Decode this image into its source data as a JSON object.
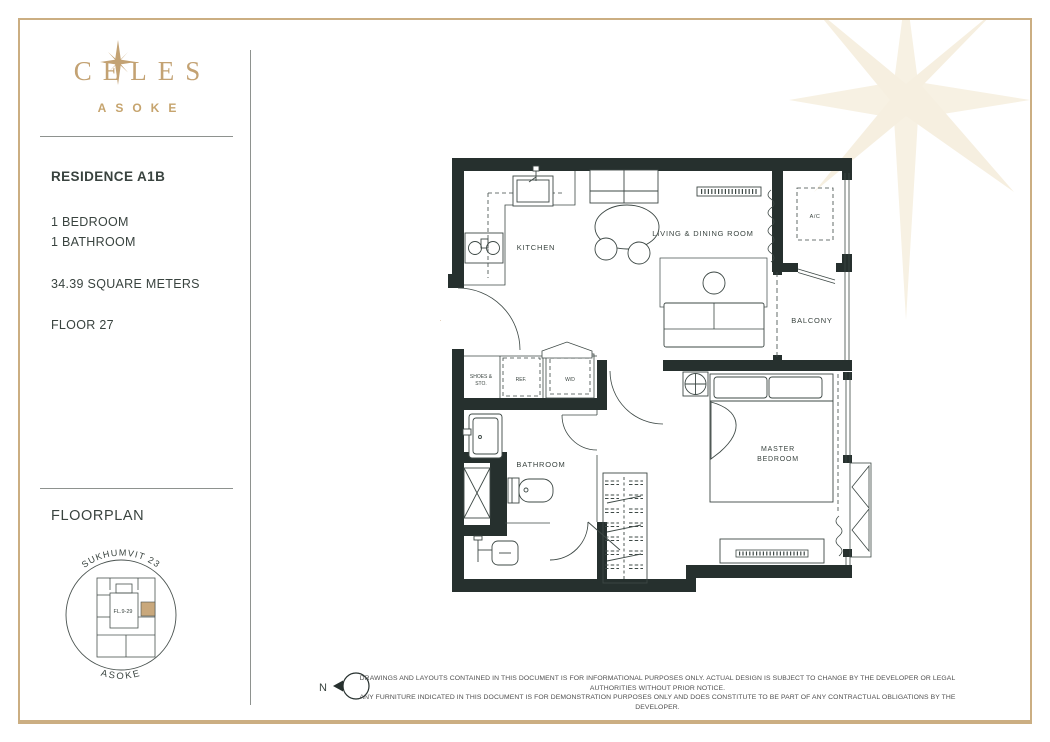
{
  "brand": {
    "name": "CELES",
    "subtitle": "ASOKE"
  },
  "unit": {
    "title": "RESIDENCE A1B",
    "bedroom": "1 BEDROOM",
    "bathroom": "1 BATHROOM",
    "area": "34.39 SQUARE METERS",
    "floor": "FLOOR 27"
  },
  "floorplan": {
    "heading": "FLOORPLAN",
    "keyplan": {
      "street_top": "SUKHUMVIT 23",
      "street_bottom": "ASOKE",
      "floors": "FL.9-29"
    }
  },
  "plan": {
    "labels": {
      "kitchen": "KITCHEN",
      "living": "LIVING & DINING ROOM",
      "ac": "A/C",
      "balcony": "BALCONY",
      "shoes1": "SHOES &",
      "shoes2": "STO.",
      "ref": "REF.",
      "wd": "W/D",
      "bathroom": "BATHROOM",
      "master1": "MASTER",
      "master2": "BEDROOM"
    }
  },
  "footer": {
    "north": "N",
    "disclaimer1": "DRAWINGS AND LAYOUTS CONTAINED IN THIS DOCUMENT IS FOR INFORMATIONAL PURPOSES ONLY. ACTUAL DESIGN IS SUBJECT TO CHANGE BY THE DEVELOPER OR LEGAL AUTHORITIES WITHOUT PRIOR NOTICE.",
    "disclaimer2": "ANY FURNITURE INDICATED IN THIS DOCUMENT IS FOR DEMONSTRATION PURPOSES ONLY AND DOES CONSTITUTE TO BE PART OF ANY CONTRACTUAL OBLIGATIONS BY THE DEVELOPER."
  },
  "colors": {
    "gold": "#C3A273",
    "wall": "#26302E",
    "unit_highlight": "#C9A87C",
    "faint_star": "#F7F1E3"
  }
}
